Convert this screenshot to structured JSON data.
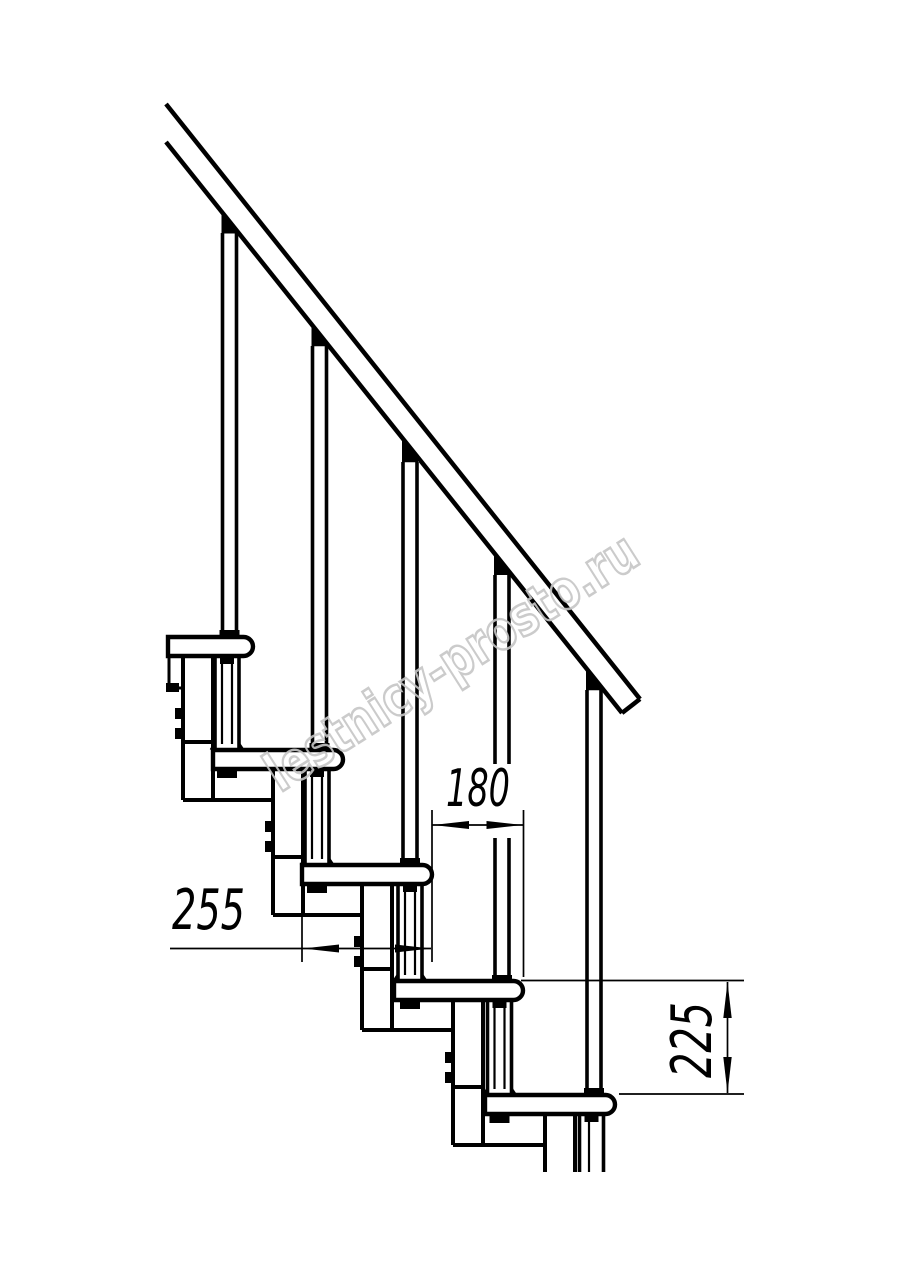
{
  "drawing": {
    "type": "staircase-side-elevation-technical-drawing",
    "background_color": "#ffffff",
    "line_color": "#000000",
    "treads_visible": 5,
    "balusters_visible": 5,
    "dimensions": [
      {
        "label": "255",
        "orientation": "horizontal",
        "measures": "tread depth"
      },
      {
        "label": "180",
        "orientation": "horizontal",
        "measures": "step run offset"
      },
      {
        "label": "225",
        "orientation": "vertical",
        "measures": "riser height"
      }
    ],
    "watermark": {
      "text": "lestnicy-prosto.ru",
      "color": "#c6c6c6"
    }
  }
}
